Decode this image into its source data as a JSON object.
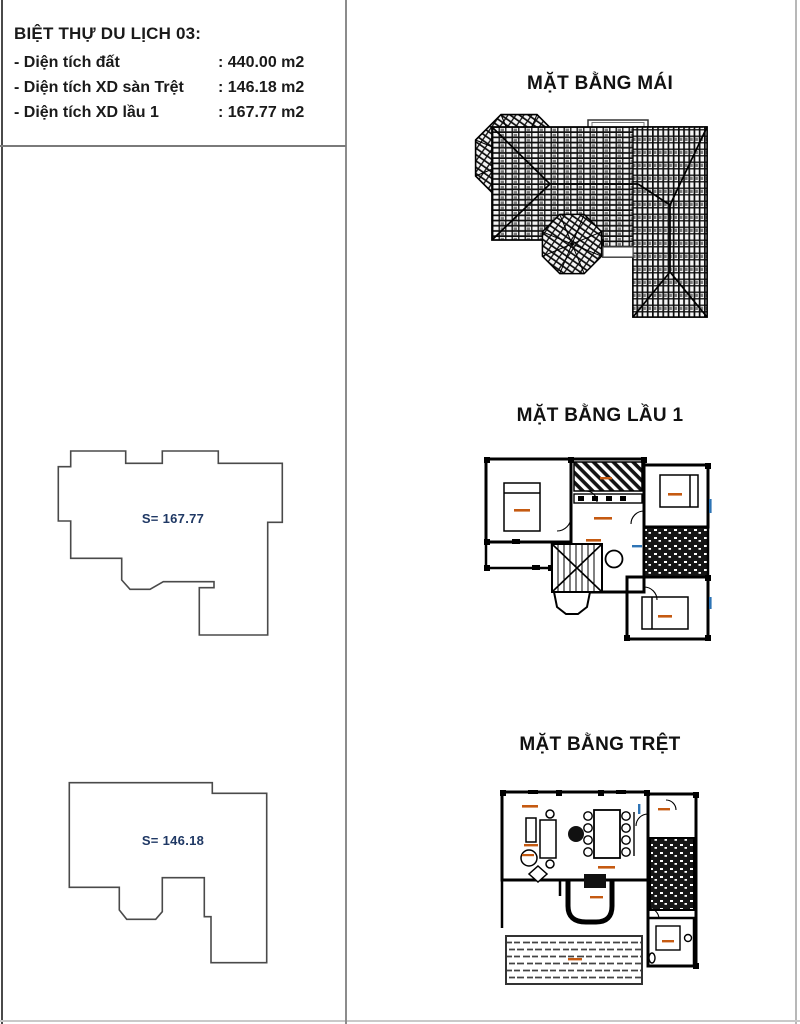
{
  "info_panel": {
    "title": "BIỆT THỰ DU LỊCH 03:",
    "rows": [
      {
        "label": "- Diện tích đất",
        "value": ": 440.00 m2"
      },
      {
        "label": "- Diện tích XD sàn Trệt",
        "value": ": 146.18 m2"
      },
      {
        "label": "- Diện tích XD lầu 1",
        "value": ": 167.77 m2"
      }
    ]
  },
  "plans": {
    "roof_title": "MẶT BẰNG MÁI",
    "floor1_title": "MẶT BẰNG LẦU 1",
    "ground_title": "MẶT BẰNG TRỆT"
  },
  "footprints": {
    "floor1_area_label": "S= 167.77",
    "ground_area_label": "S= 146.18"
  },
  "colors": {
    "area_label_navy": "#1f3864",
    "room_label_orange": "#c55a11",
    "room_label_blue": "#2e74b5",
    "drawing_line": "#3f3f3f",
    "divider_gray": "#8c8c8c"
  }
}
